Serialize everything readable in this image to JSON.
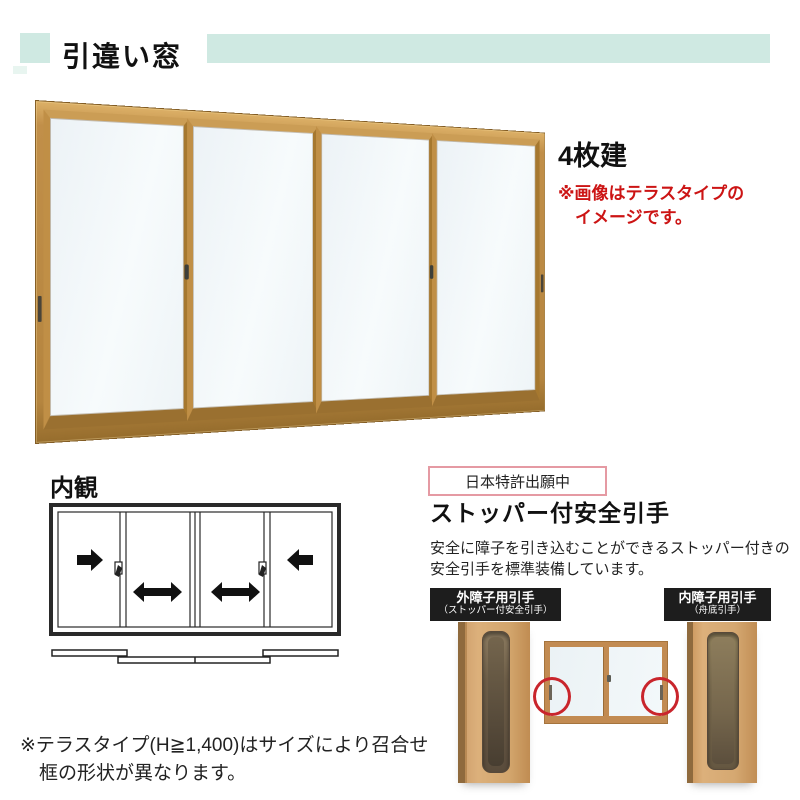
{
  "header": {
    "title": "引違い窓",
    "accent_color": "#cfe9e2"
  },
  "main_product": {
    "panel_count_label": "4枚建",
    "note_lines": [
      "※画像はテラスタイプの",
      "イメージです。"
    ],
    "note_color": "#cc1414",
    "frame_color": "#b5853f",
    "glass_color": "#f2f7f9",
    "panes": 4
  },
  "interior_view": {
    "heading": "内観"
  },
  "safety_handle": {
    "patent_label": "日本特許出願中",
    "patent_border_color": "#e59aa3",
    "heading": "ストッパー付安全引手",
    "description_lines": [
      "安全に障子を引き込むことができるストッパー付きの",
      "安全引手を標準装備しています。"
    ],
    "outer_label": {
      "title": "外障子用引手",
      "subtitle": "（ストッパー付安全引手）"
    },
    "inner_label": {
      "title": "内障子用引手",
      "subtitle": "（舟底引手）"
    },
    "label_bg_color": "#1d1d1d",
    "highlight_circle_color": "#c9252c"
  },
  "footnote_lines": [
    "※テラスタイプ(H≧1,400)はサイズにより召合せ",
    "框の形状が異なります。"
  ]
}
